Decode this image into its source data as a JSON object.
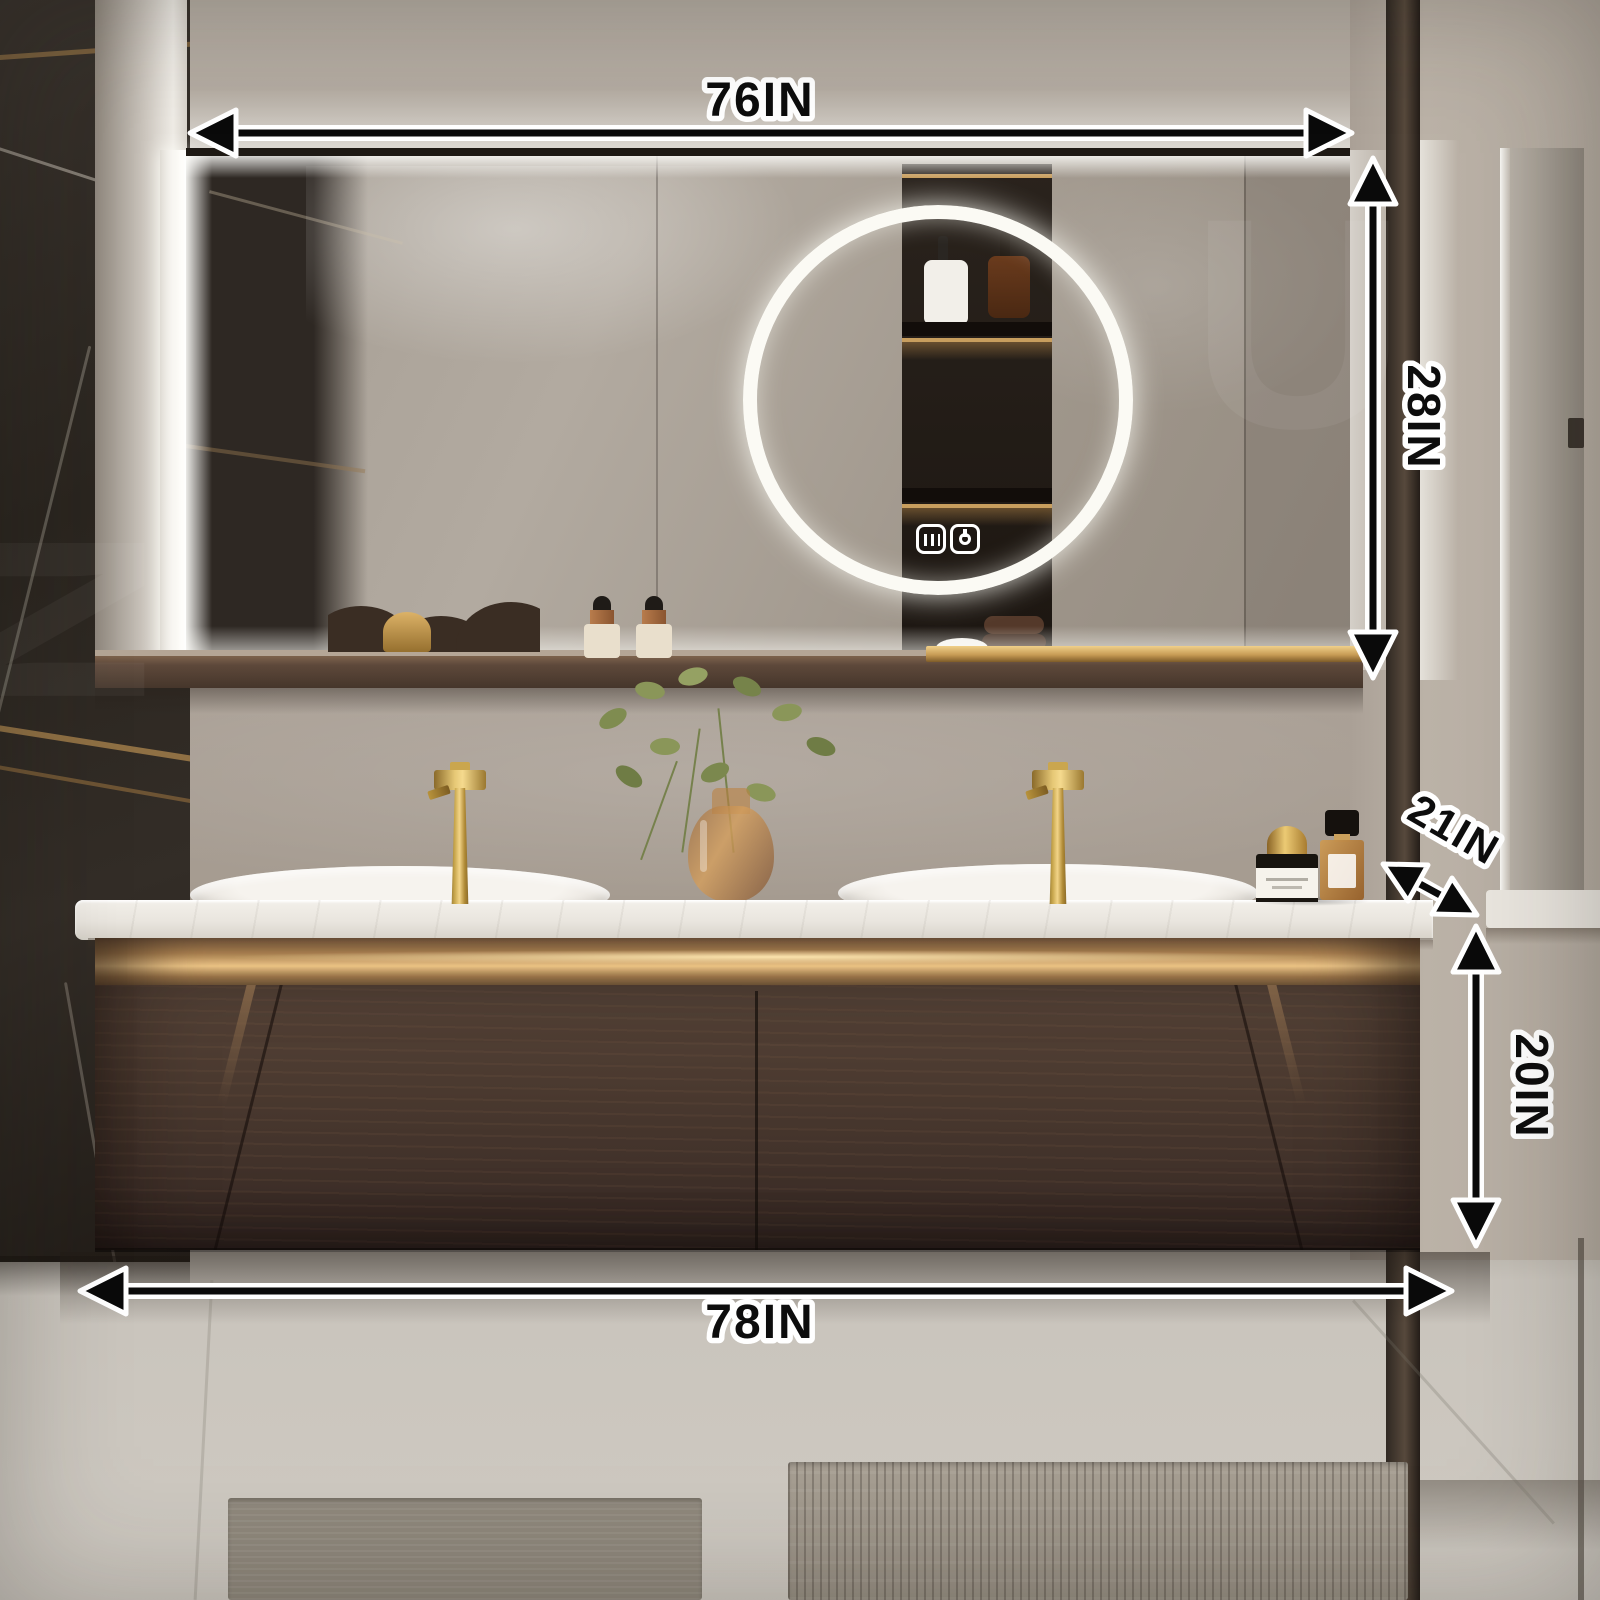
{
  "diagram": {
    "subject": "Wall-mounted double-sink bathroom vanity with LED mirror — dimension diagram",
    "dimensions": [
      {
        "id": "top-width",
        "label": "76IN",
        "orientation": "horizontal",
        "position": "top"
      },
      {
        "id": "mirror-height",
        "label": "28IN",
        "orientation": "vertical",
        "position": "right-of-mirror"
      },
      {
        "id": "counter-depth",
        "label": "21IN",
        "orientation": "diagonal",
        "position": "right-counter-corner"
      },
      {
        "id": "cabinet-height",
        "label": "20IN",
        "orientation": "vertical",
        "position": "right-of-cabinet"
      },
      {
        "id": "bottom-width",
        "label": "78IN",
        "orientation": "horizontal",
        "position": "bottom"
      }
    ],
    "annotation_style": {
      "text_color": "#0d0d0d",
      "outline_color": "#ffffff",
      "arrow_color": "#0a0a0a"
    }
  },
  "scene": {
    "mirror_touch_icons": [
      "defogger-icon",
      "light-power-icon"
    ],
    "colors": {
      "gold_accent": "#c9a050",
      "walnut_cabinet": "#4a392e",
      "counter_white": "#ece8e1",
      "wall_greige": "#a89e93",
      "marble_dark": "#2e2823",
      "led_white": "#f7f5ee",
      "floor_grey": "#c6c1b9"
    }
  },
  "watermark": {
    "letters": [
      "U",
      "N"
    ]
  }
}
